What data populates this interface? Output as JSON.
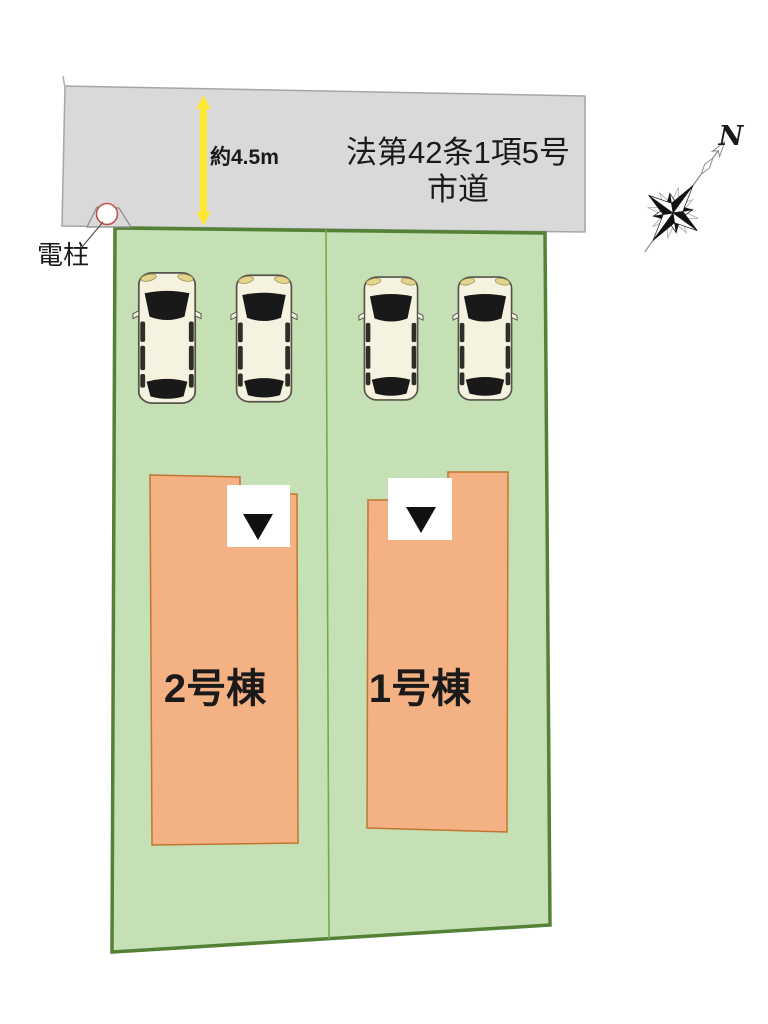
{
  "plan_title": "site-plan",
  "road": {
    "law_label_line1": "法第42条1項5号",
    "law_label_line2": "市道",
    "width_label": "約4.5m"
  },
  "pole": {
    "label": "電柱"
  },
  "buildings": [
    {
      "label": "2号棟"
    },
    {
      "label": "1号棟"
    }
  ],
  "compass": {
    "north_label": "N"
  },
  "cars": {
    "count": 4
  },
  "colors": {
    "road_fill": "#d9d9d9",
    "road_stroke": "#a6a6a6",
    "plot_fill": "#c5e0b4",
    "plot_stroke": "#538135",
    "divider_stroke": "#70ad47",
    "building_fill": "#f4b183",
    "building_stroke": "#c0762f",
    "arrow_yellow": "#ffe933",
    "pole_circle_stroke": "#c0504d",
    "entrance_marker": "#111111",
    "car_body": "#f6f2e0",
    "text_color": "#1a1a1a"
  }
}
